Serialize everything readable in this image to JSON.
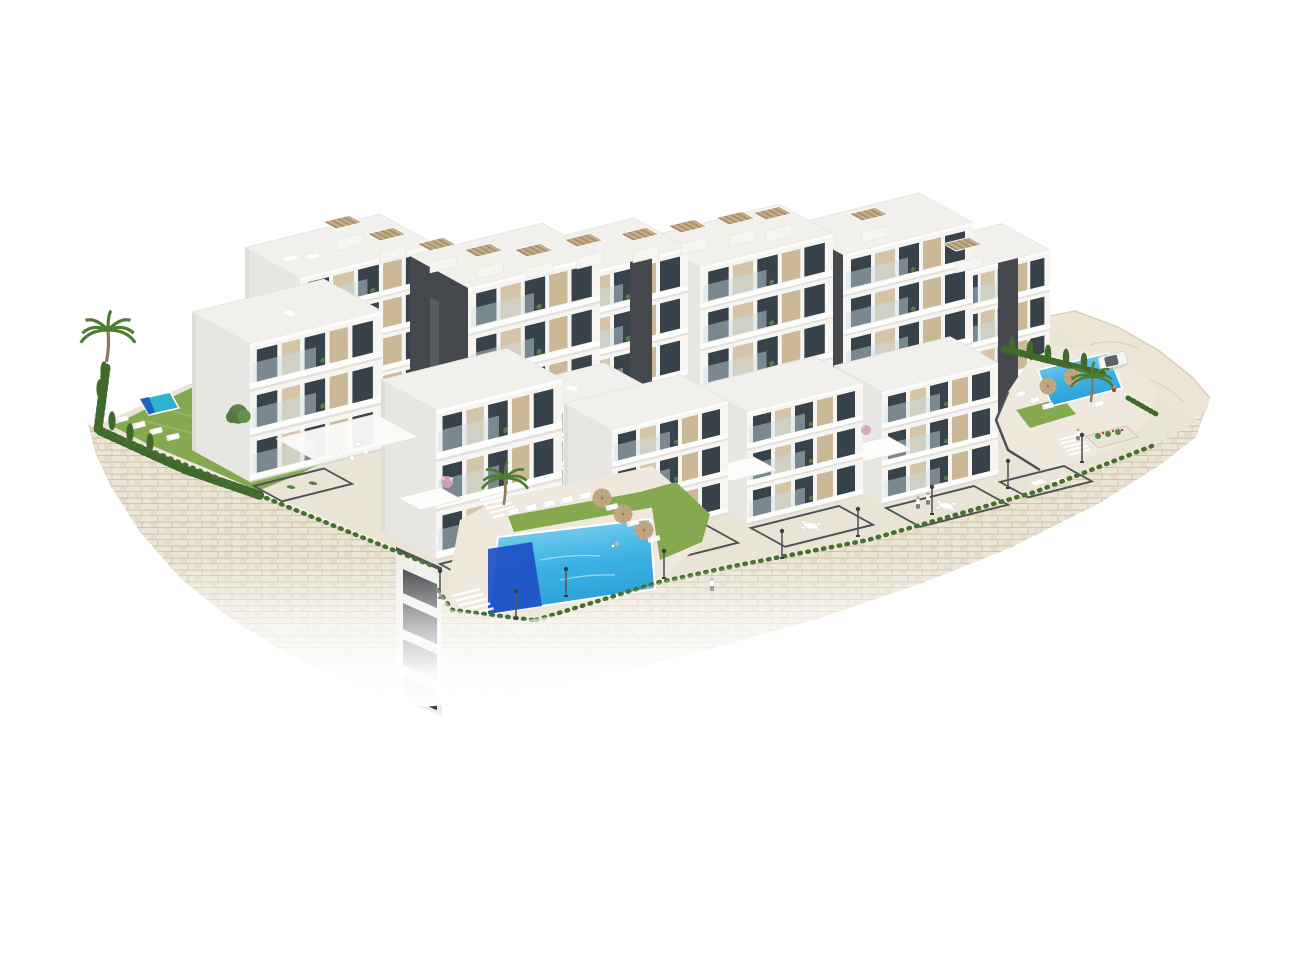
{
  "scene": {
    "type": "architectural-3d-render",
    "subject": "hillside-residential-apartment-complex-aerial-view",
    "background": "plain-white"
  },
  "colors": {
    "background": "#ffffff",
    "stone_light": "#ece5d6",
    "stone_mid": "#ded4c0",
    "stone_dark": "#cfc3aa",
    "stone_line": "#cdc1a8",
    "rock": "#ede6d4",
    "rock_line": "#d6cab2",
    "paving": "#e9e4d6",
    "deck": "#eee9dc",
    "lawn": "#85a94f",
    "lawn_light": "#95ba5e",
    "hedge": "#47702f",
    "cypress": "#3f6a2c",
    "tree": "#5c8143",
    "palm": "#4e7d33",
    "pool_deep": "#1d50c4",
    "pool_teal": "#2fb3cc",
    "umbrella": "#c3a982",
    "pergola_tan": "#c5ad8b",
    "pergola_line": "#a8906c",
    "charcoal": "#4c5155",
    "lamp": "#54575a",
    "bldg_face": "#f6f5f2",
    "bldg_side": "#e7e6e2",
    "slab_white": "#fdfdfc",
    "panel_beige": "#d5c4a8",
    "panel_beige2": "#cbb896",
    "core_dark": "#45484c",
    "glass_dark": "#37424a",
    "balust": "#cbdfe6",
    "flower_pink": "#d8a0c0",
    "person_red": "#c0392b",
    "car_glass": "#404a50"
  },
  "inventory": {
    "apartment_blocks": 12,
    "swimming_pools": 3,
    "rooftop_pergolas": 12,
    "private_garden_terraces": 6,
    "dining_sets": 4,
    "sun_umbrellas": 5,
    "sun_loungers": 20,
    "street_lamps": 9,
    "palm_trees": 3,
    "parked_cars": 1,
    "people": 5
  }
}
